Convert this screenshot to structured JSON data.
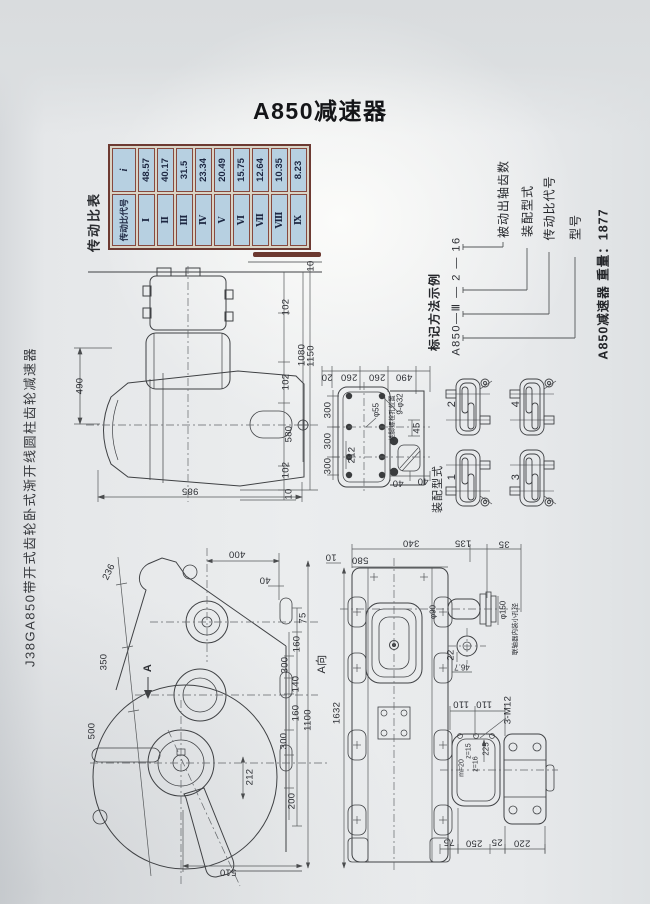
{
  "page": {
    "title": "A850减速器",
    "side_caption": "J38GA850带开式齿轮卧式渐开线圆柱齿轮减速器"
  },
  "ratio_table": {
    "caption": "传动比表",
    "col_code": "传动比代号",
    "col_i": "i",
    "rows": [
      {
        "code": "Ⅰ",
        "i": "48.57"
      },
      {
        "code": "Ⅱ",
        "i": "40.17"
      },
      {
        "code": "Ⅲ",
        "i": "31.5"
      },
      {
        "code": "Ⅳ",
        "i": "23.34"
      },
      {
        "code": "Ⅴ",
        "i": "20.49"
      },
      {
        "code": "Ⅵ",
        "i": "15.75"
      },
      {
        "code": "Ⅶ",
        "i": "12.64"
      },
      {
        "code": "Ⅷ",
        "i": "10.35"
      },
      {
        "code": "Ⅸ",
        "i": "8.23"
      }
    ]
  },
  "marking": {
    "caption": "标记方法示例",
    "example": "A850—Ⅲ — 2 — 16",
    "label_teeth": "被动出轴齿数",
    "label_assembly": "装配型式",
    "label_ratio": "传动比代号",
    "label_model": "型号",
    "weight_note": "A850减速器 重量：1877"
  },
  "assembly": {
    "caption": "装配型式",
    "type1": "1",
    "type2": "2",
    "type3": "3",
    "type4": "4"
  },
  "side_view": {
    "top10": "10",
    "d102a": "102",
    "d1080": "1080",
    "d1150": "1150",
    "d102b": "102",
    "d580": "580",
    "d102c": "102",
    "bottom10": "10",
    "d490": "490",
    "d985": "985"
  },
  "plan_view": {
    "d20": "20",
    "d260a": "260",
    "d260b": "260",
    "d490": "490",
    "d300a": "300",
    "d300b": "300",
    "d300c": "300",
    "d212": "212",
    "bore": "φ55",
    "holes": "9-φ32",
    "note": "地脚螺栓孔位置",
    "d45": "45",
    "d40a": "40",
    "d40b": "40"
  },
  "gear_view": {
    "d236": "236",
    "d350": "350",
    "d500": "500",
    "section": "A",
    "d400": "400",
    "d40": "40",
    "d75": "75",
    "d160a": "160",
    "d300a": "300",
    "d140": "140",
    "d160b": "160",
    "d300b": "300",
    "d200": "200",
    "d1100": "1100",
    "d212": "212",
    "d510": "510"
  },
  "front_view": {
    "d10": "10",
    "d580": "580",
    "d340": "340",
    "d135": "135",
    "d35": "35",
    "phi90": "φ90",
    "d22": "22",
    "d46_7": "46.7",
    "phi150": "φ150",
    "note": "联轴器内装小孔径",
    "bolts": "3-M12",
    "d110a": "110",
    "d110b": "110",
    "gear_m": "m=20",
    "gear_z1": "z=15",
    "gear_z2": "z=16",
    "d225": "225",
    "d75": "75",
    "d250": "250",
    "d25": "25",
    "d220": "220",
    "d1632": "1632",
    "view_dir": "A向"
  }
}
